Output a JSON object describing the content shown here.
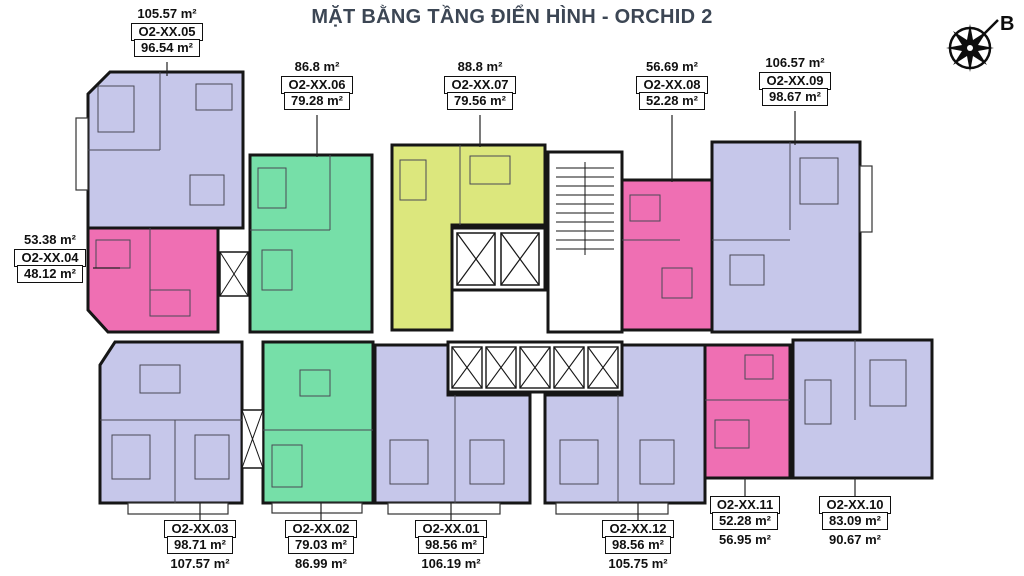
{
  "title": "MẶT BẰNG TẦNG ĐIỂN HÌNH - ORCHID 2",
  "compass": {
    "label": "B"
  },
  "palette": {
    "lavender": "#c6c7ea",
    "green": "#76dfa8",
    "yellow": "#dce77d",
    "pink": "#ef6fb3",
    "wall": "#161616",
    "title_text": "#3c4654"
  },
  "units": [
    {
      "name": "O2-XX.01",
      "boxed_area": "98.56 m²",
      "outer_area": "106.19 m²",
      "color": "#c6c7ea"
    },
    {
      "name": "O2-XX.02",
      "boxed_area": "79.03 m²",
      "outer_area": "86.99 m²",
      "color": "#76dfa8"
    },
    {
      "name": "O2-XX.03",
      "boxed_area": "98.71 m²",
      "outer_area": "107.57 m²",
      "color": "#c6c7ea"
    },
    {
      "name": "O2-XX.04",
      "boxed_area": "48.12 m²",
      "outer_area": "53.38 m²",
      "color": "#ef6fb3"
    },
    {
      "name": "O2-XX.05",
      "boxed_area": "96.54 m²",
      "outer_area": "105.57 m²",
      "color": "#c6c7ea"
    },
    {
      "name": "O2-XX.06",
      "boxed_area": "79.28 m²",
      "outer_area": "86.8 m²",
      "color": "#76dfa8"
    },
    {
      "name": "O2-XX.07",
      "boxed_area": "79.56 m²",
      "outer_area": "88.8 m²",
      "color": "#dce77d"
    },
    {
      "name": "O2-XX.08",
      "boxed_area": "52.28 m²",
      "outer_area": "56.69 m²",
      "color": "#ef6fb3"
    },
    {
      "name": "O2-XX.09",
      "boxed_area": "98.67 m²",
      "outer_area": "106.57 m²",
      "color": "#c6c7ea"
    },
    {
      "name": "O2-XX.10",
      "boxed_area": "83.09 m²",
      "outer_area": "90.67 m²",
      "color": "#c6c7ea"
    },
    {
      "name": "O2-XX.11",
      "boxed_area": "52.28 m²",
      "outer_area": "56.95 m²",
      "color": "#ef6fb3"
    },
    {
      "name": "O2-XX.12",
      "boxed_area": "98.56 m²",
      "outer_area": "105.75 m²",
      "color": "#c6c7ea"
    }
  ]
}
